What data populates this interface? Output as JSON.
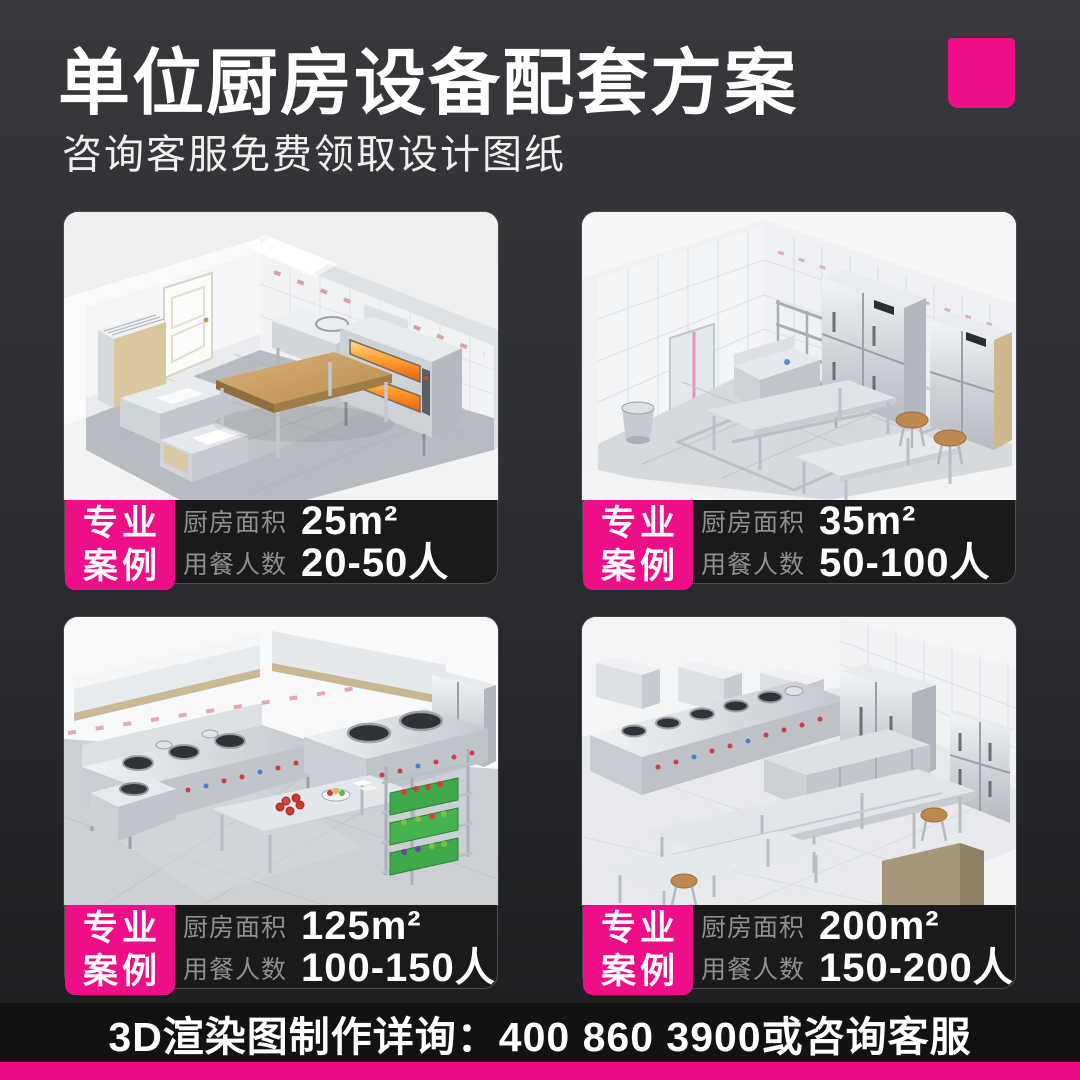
{
  "page": {
    "title": "单位厨房设备配套方案",
    "subtitle": "咨询客服免费领取设计图纸",
    "footer": "3D渲染图制作详询：400 860 3900或咨询客服"
  },
  "colors": {
    "accent": "#EE0E87",
    "accent_bar": "#EC0A84",
    "panel": "#1A1A1A",
    "background_top": "#37383B",
    "background_bottom": "#1C1D1F"
  },
  "badge": {
    "line1": "专业",
    "line2": "案例"
  },
  "labels": {
    "area": "厨房面积",
    "diners": "用餐人数"
  },
  "cases": [
    {
      "area": "25m²",
      "diners": "20-50人"
    },
    {
      "area": "35m²",
      "diners": "50-100人"
    },
    {
      "area": "125m²",
      "diners": "100-150人"
    },
    {
      "area": "200m²",
      "diners": "150-200人"
    }
  ]
}
